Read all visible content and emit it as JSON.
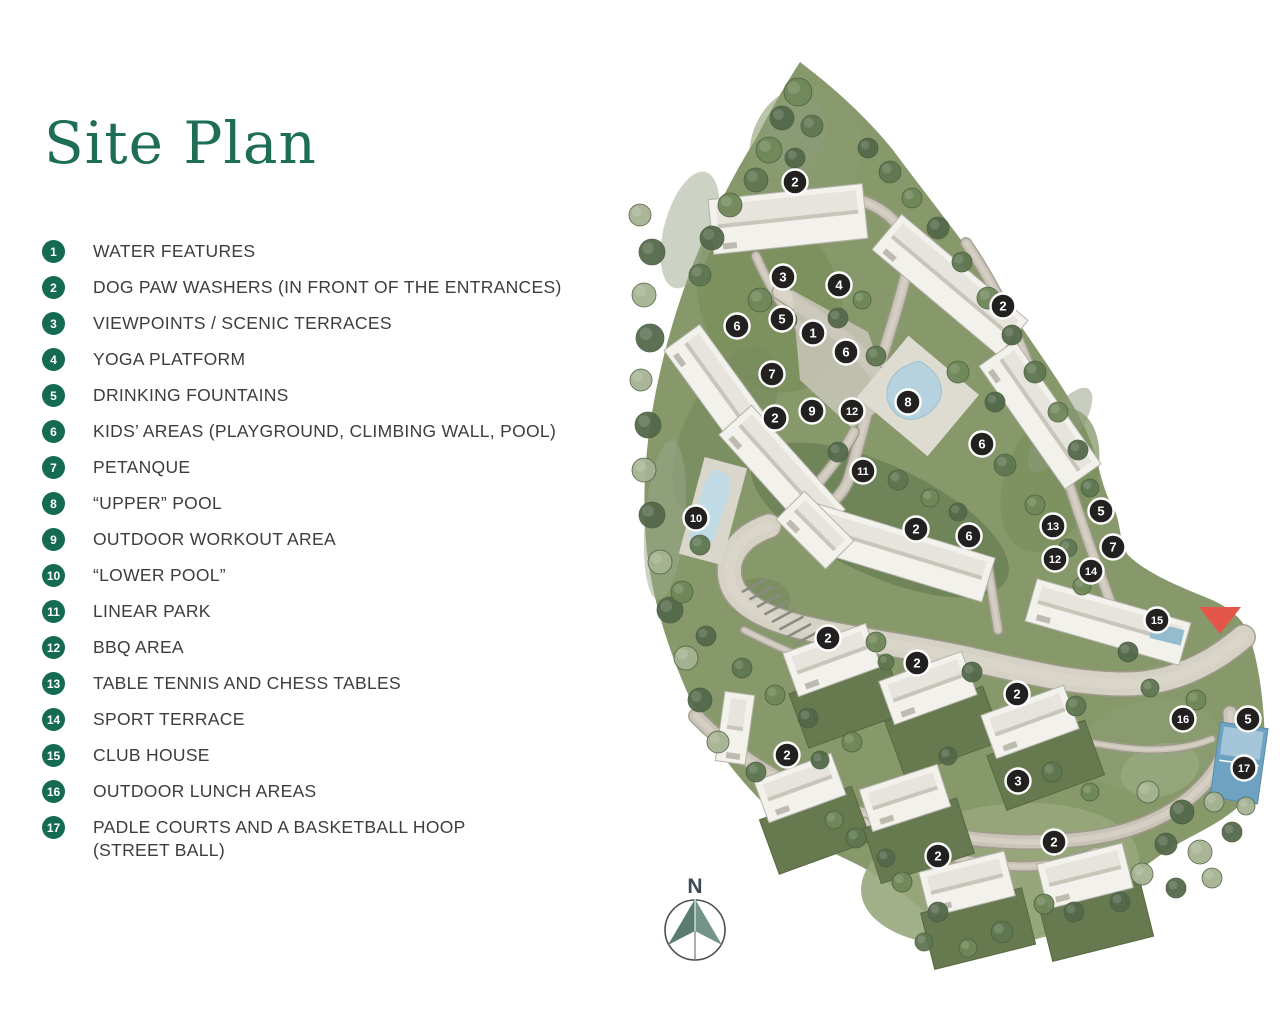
{
  "title": "Site Plan",
  "colors": {
    "title_green": "#1E6E57",
    "badge_green": "#156A52",
    "marker_dark": "#222120",
    "entrance_red": "#E4564A",
    "compass_teal": "#5A7C70"
  },
  "legend": [
    {
      "num": "1",
      "label": "WATER FEATURES"
    },
    {
      "num": "2",
      "label": "DOG PAW WASHERS (IN FRONT OF THE ENTRANCES)"
    },
    {
      "num": "3",
      "label": "VIEWPOINTS / SCENIC TERRACES"
    },
    {
      "num": "4",
      "label": "YOGA PLATFORM"
    },
    {
      "num": "5",
      "label": "DRINKING FOUNTAINS"
    },
    {
      "num": "6",
      "label": "KIDS’ AREAS (PLAYGROUND, CLIMBING WALL, POOL)"
    },
    {
      "num": "7",
      "label": "PETANQUE"
    },
    {
      "num": "8",
      "label": "“UPPER” POOL"
    },
    {
      "num": "9",
      "label": "OUTDOOR WORKOUT AREA"
    },
    {
      "num": "10",
      "label": "“LOWER POOL”"
    },
    {
      "num": "11",
      "label": "LINEAR PARK"
    },
    {
      "num": "12",
      "label": "BBQ AREA"
    },
    {
      "num": "13",
      "label": "TABLE TENNIS AND CHESS TABLES"
    },
    {
      "num": "14",
      "label": "SPORT TERRACE"
    },
    {
      "num": "15",
      "label": "CLUB HOUSE"
    },
    {
      "num": "16",
      "label": "OUTDOOR LUNCH AREAS"
    },
    {
      "num": "17",
      "label": "PADLE COURTS AND A BASKETBALL HOOP",
      "label2": "(STREET BALL)"
    }
  ],
  "compass": {
    "label": "N"
  },
  "map_markers": [
    {
      "n": "2",
      "x": 795,
      "y": 182
    },
    {
      "n": "3",
      "x": 783,
      "y": 277
    },
    {
      "n": "4",
      "x": 839,
      "y": 285
    },
    {
      "n": "2",
      "x": 1003,
      "y": 306
    },
    {
      "n": "6",
      "x": 737,
      "y": 326
    },
    {
      "n": "5",
      "x": 782,
      "y": 319
    },
    {
      "n": "1",
      "x": 813,
      "y": 333
    },
    {
      "n": "6",
      "x": 846,
      "y": 352
    },
    {
      "n": "7",
      "x": 772,
      "y": 374
    },
    {
      "n": "2",
      "x": 775,
      "y": 418
    },
    {
      "n": "9",
      "x": 812,
      "y": 411
    },
    {
      "n": "12",
      "x": 852,
      "y": 411
    },
    {
      "n": "8",
      "x": 908,
      "y": 402
    },
    {
      "n": "6",
      "x": 982,
      "y": 444
    },
    {
      "n": "11",
      "x": 863,
      "y": 471
    },
    {
      "n": "10",
      "x": 696,
      "y": 518
    },
    {
      "n": "2",
      "x": 916,
      "y": 529
    },
    {
      "n": "6",
      "x": 969,
      "y": 536
    },
    {
      "n": "13",
      "x": 1053,
      "y": 526
    },
    {
      "n": "5",
      "x": 1101,
      "y": 511
    },
    {
      "n": "7",
      "x": 1113,
      "y": 547
    },
    {
      "n": "12",
      "x": 1055,
      "y": 559
    },
    {
      "n": "14",
      "x": 1091,
      "y": 571
    },
    {
      "n": "15",
      "x": 1157,
      "y": 620
    },
    {
      "n": "2",
      "x": 828,
      "y": 638
    },
    {
      "n": "2",
      "x": 917,
      "y": 663
    },
    {
      "n": "2",
      "x": 1017,
      "y": 694
    },
    {
      "n": "16",
      "x": 1183,
      "y": 719
    },
    {
      "n": "5",
      "x": 1248,
      "y": 719
    },
    {
      "n": "17",
      "x": 1244,
      "y": 768
    },
    {
      "n": "2",
      "x": 787,
      "y": 755
    },
    {
      "n": "3",
      "x": 1018,
      "y": 781
    },
    {
      "n": "2",
      "x": 938,
      "y": 856
    },
    {
      "n": "2",
      "x": 1054,
      "y": 842
    }
  ],
  "entrance": {
    "x": 1220,
    "y": 607
  }
}
